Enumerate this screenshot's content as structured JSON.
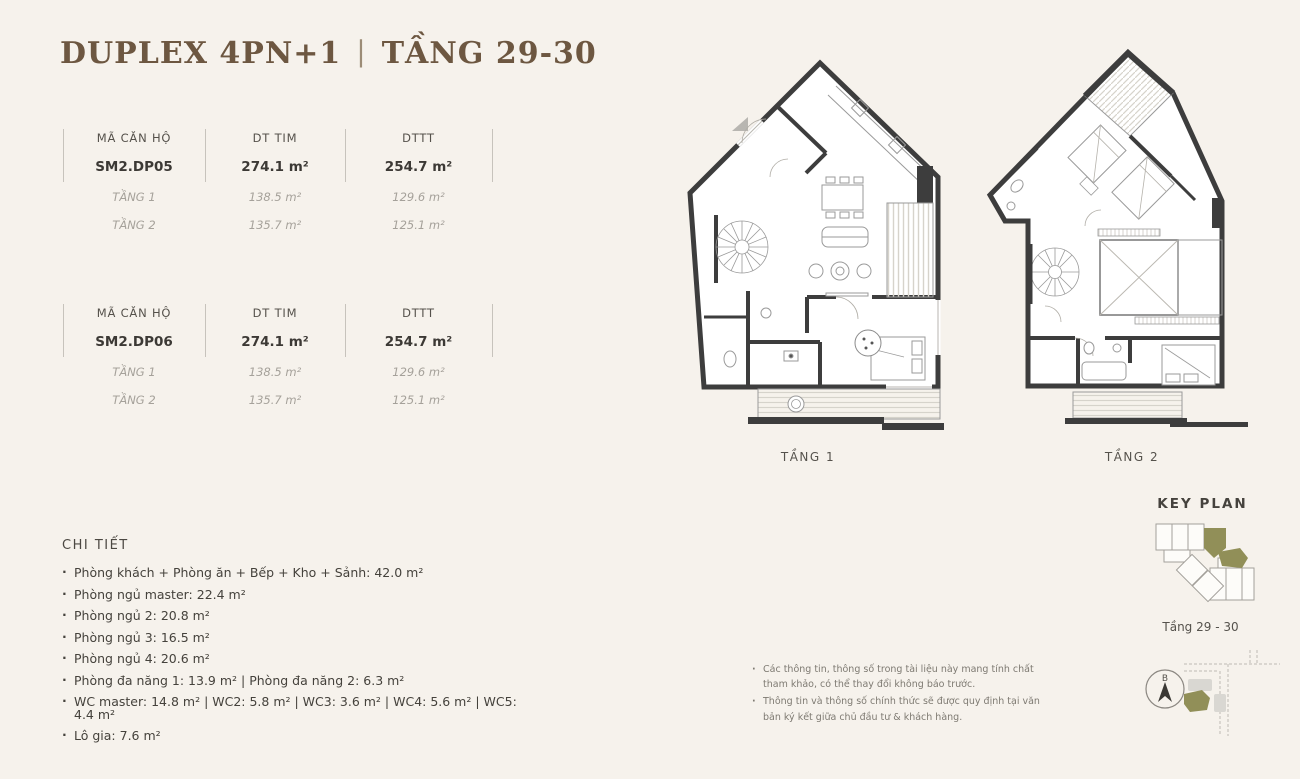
{
  "title": {
    "name": "DUPLEX 4PN+1",
    "divider": "|",
    "floors": "TẦNG 29-30"
  },
  "unit_tables": [
    {
      "headers": {
        "code": "MÃ CĂN HỘ",
        "dt_tim": "DT TIM",
        "dttt": "DTTT"
      },
      "unit": {
        "code": "SM2.DP05",
        "dt_tim": "274.1 m²",
        "dttt": "254.7 m²"
      },
      "floors": [
        {
          "label": "TẦNG 1",
          "dt_tim": "138.5 m²",
          "dttt": "129.6 m²"
        },
        {
          "label": "TẦNG 2",
          "dt_tim": "135.7 m²",
          "dttt": "125.1 m²"
        }
      ]
    },
    {
      "headers": {
        "code": "MÃ CĂN HỘ",
        "dt_tim": "DT TIM",
        "dttt": "DTTT"
      },
      "unit": {
        "code": "SM2.DP06",
        "dt_tim": "274.1 m²",
        "dttt": "254.7 m²"
      },
      "floors": [
        {
          "label": "TẦNG 1",
          "dt_tim": "138.5 m²",
          "dttt": "129.6 m²"
        },
        {
          "label": "TẦNG 2",
          "dt_tim": "135.7 m²",
          "dttt": "125.1 m²"
        }
      ]
    }
  ],
  "details": {
    "heading": "CHI TIẾT",
    "items": [
      "Phòng khách + Phòng ăn + Bếp + Kho + Sảnh: 42.0 m²",
      "Phòng ngủ master: 22.4 m²",
      "Phòng ngủ 2: 20.8 m²",
      "Phòng ngủ 3: 16.5 m²",
      "Phòng ngủ 4: 20.6 m²",
      "Phòng đa năng 1: 13.9 m² |  Phòng đa năng 2: 6.3 m²",
      "WC master: 14.8 m² | WC2: 5.8 m² | WC3: 3.6 m² | WC4: 5.6 m² | WC5: 4.4 m²",
      "Lô gia: 7.6 m²"
    ]
  },
  "floorplans": [
    {
      "label": "TẦNG 1"
    },
    {
      "label": "TẦNG 2"
    }
  ],
  "keyplan": {
    "title": "KEY PLAN",
    "caption": "Tầng 29 - 30"
  },
  "notes": [
    "Các thông tin, thông số trong tài liệu này mang tính chất tham khảo, có thể thay đổi không báo trước.",
    "Thông tin và thông số chính thức sẽ được quy định tại văn bản ký kết giữa chủ đầu tư & khách hàng."
  ],
  "compass": {
    "label": "B"
  },
  "colors": {
    "background": "#f6f2ec",
    "title_brown": "#6d5741",
    "accent_olive": "#918f58",
    "wall_dark": "#3d3d3d",
    "text_dark": "#45423c",
    "text_muted": "#a5a19a"
  }
}
